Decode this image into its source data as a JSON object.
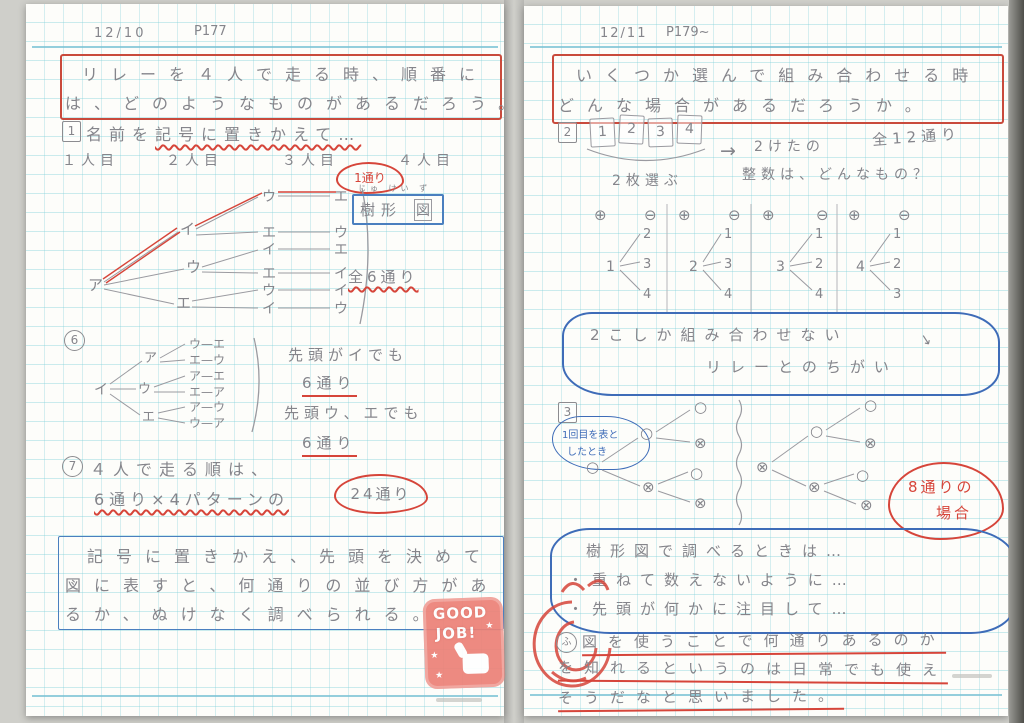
{
  "page": {
    "left": {
      "date": "12/10",
      "page_ref": "P177",
      "title": {
        "line1": "リレーを４人で走る時、順番に",
        "line2": "は、どのようなものがあるだろう。"
      },
      "step1": {
        "marker": "1",
        "pre": "名前を",
        "underlined": "記号に置きかえて…"
      },
      "runners": [
        "１人目",
        "２人目",
        "３人目",
        "４人目"
      ],
      "cloud_one_way": "1通り",
      "tree_label": {
        "furigana": "じゅ けい ず",
        "text1": "樹形",
        "text2": "図"
      },
      "total_six": "全6通り",
      "main_tree": {
        "root": "ア",
        "level2": [
          "イ",
          "ウ",
          "エ"
        ],
        "level3": [
          "ウ",
          "エ",
          "イ",
          "エ",
          "ウ",
          "イ"
        ],
        "level4": [
          "エ",
          "ウ",
          "エ",
          "イ",
          "イ",
          "ウ"
        ]
      },
      "step6": {
        "marker": "6",
        "tree": {
          "root": "イ",
          "level2": [
            "ア",
            "ウ",
            "エ"
          ],
          "leaves": [
            "ウ—エ",
            "エ—ウ",
            "ア—エ",
            "エ—ア",
            "ア—ウ",
            "ウ—ア"
          ]
        },
        "note1": "先頭がイでも",
        "count1": "6通り",
        "note2": "先頭ウ、エでも",
        "count2": "6通り"
      },
      "step7": {
        "marker": "7",
        "line1": "４人で走る順は、",
        "formula": "6通り×4パターンの",
        "cloud": "24通り"
      },
      "summary": {
        "line1": "記号に置きかえ、先頭を決めて",
        "line2": "図に表すと、何通りの並び方があ",
        "line3": "るか、ぬけなく調べられる。"
      },
      "stamp": {
        "line1": "GOOD",
        "line2": "JOB!",
        "star": "★"
      }
    },
    "right": {
      "date": "12/11",
      "page_ref": "P179~",
      "title": {
        "line1": "いくつか選んで組み合わせる時",
        "line2": "どんな場合があるだろうか。"
      },
      "step2": {
        "marker": "2",
        "cards": [
          "1",
          "2",
          "3",
          "4"
        ],
        "pick_label": "2枚選ぶ",
        "arrow": "→",
        "question1": "2けたの",
        "question2": "整数は、どんなもの？",
        "total": "全12通り"
      },
      "place_marks": {
        "tens": "⊕",
        "ones": "⊖"
      },
      "digit_trees": [
        {
          "root": "1",
          "children": [
            "2",
            "3",
            "4"
          ]
        },
        {
          "root": "2",
          "children": [
            "1",
            "3",
            "4"
          ]
        },
        {
          "root": "3",
          "children": [
            "1",
            "2",
            "4"
          ]
        },
        {
          "root": "4",
          "children": [
            "1",
            "2",
            "3"
          ]
        }
      ],
      "cloud_compare": {
        "line1": "2こしか組み合わせない",
        "arrow": "↘",
        "line2": "リレーとのちがい"
      },
      "step3": {
        "marker": "3",
        "note_line1": "1回目を表と",
        "note_line2": "したとき",
        "coin_tree_left": {
          "root": "○",
          "level2": [
            "○",
            "⊗"
          ],
          "level3": [
            "○",
            "⊗",
            "○",
            "⊗"
          ]
        },
        "coin_tree_right": {
          "root": "⊗",
          "level2": [
            "○",
            "⊗"
          ],
          "level3": [
            "○",
            "⊗",
            "○",
            "⊗"
          ]
        },
        "cloud_count": {
          "line1": "8通りの",
          "line2": "場合"
        }
      },
      "checklist": {
        "line1": "樹形図で調べるときは…",
        "line2": "・重ねて数えないように…",
        "line3": "・先頭が何かに注目して…"
      },
      "reflection": {
        "marker": "ふ",
        "line1": "図を使うことで何通りあるのか",
        "line2": "を知れるというのは日常でも使え",
        "line3": "そうだなと思いました。"
      }
    }
  }
}
